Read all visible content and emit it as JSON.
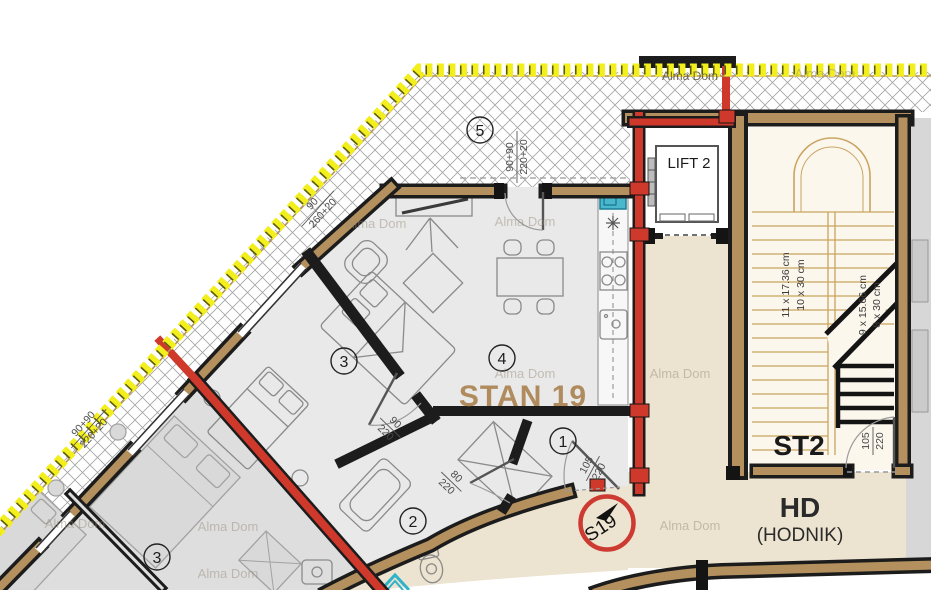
{
  "plan": {
    "apartment_label": "STAN 19",
    "rooms": {
      "terrace": "5",
      "living": "4",
      "bedroom": "3",
      "bathroom": "2",
      "hall": "1",
      "neighbor_bedroom": "3"
    },
    "lift": {
      "label": "LIFT 2"
    },
    "stairwell": {
      "label": "ST2",
      "flight_upper_risers": "11 x 17.36 cm",
      "flight_upper_treads": "10 x 30 cm",
      "flight_lower_risers": "9 x 15.66 cm",
      "flight_lower_treads": "8 x 30 cm"
    },
    "corridor": {
      "label": "HD",
      "sublabel": "(HODNIK)"
    },
    "entry_marker": {
      "label": "S19"
    },
    "watermark": "Alma Dom",
    "dims": {
      "terrace_door": {
        "w": "90+90",
        "h": "220+20"
      },
      "bedroom_window": {
        "w": "90",
        "h": "260+20"
      },
      "neighbor_window": {
        "w": "90+90",
        "h": "220+20"
      },
      "bedroom_door": {
        "w": "90",
        "h": "220"
      },
      "bath_door": {
        "w": "80",
        "h": "220"
      },
      "entry_door": {
        "w": "105",
        "h": "220"
      },
      "stair_door": {
        "w": "105",
        "h": "220"
      }
    },
    "colors": {
      "insulation_yellow": "#f2ef1d",
      "wall_red": "#ce392b",
      "wall_brown": "#b3905d",
      "corridor_beige": "#ece3d0",
      "floor_gray": "#e9e9e9",
      "neighbor_gray": "#dedede",
      "fixture_teal": "#2fb3c9",
      "label_brown": "#b08b5e",
      "marker_red": "#cd3a31"
    }
  }
}
